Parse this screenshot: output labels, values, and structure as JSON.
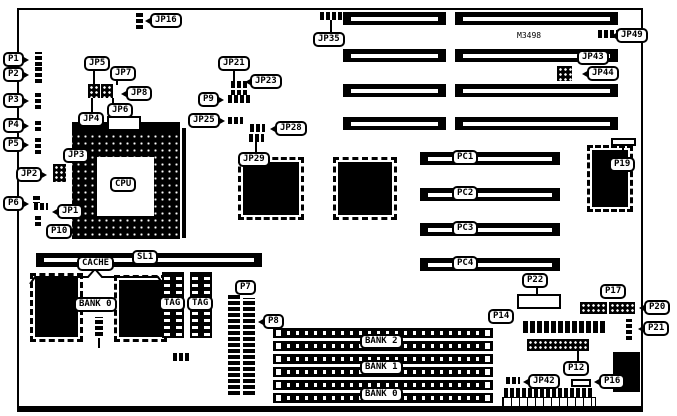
{
  "diagram": {
    "title": "motherboard jumper/connector location diagram",
    "part_number": "M3498",
    "background": "#ffffff",
    "line_color": "#000000"
  },
  "labels": [
    {
      "id": "jp16",
      "text": "JP16",
      "x": 150,
      "y": 13,
      "tail": "left"
    },
    {
      "id": "p1",
      "text": "P1",
      "x": 3,
      "y": 52,
      "tail": "right"
    },
    {
      "id": "p2",
      "text": "P2",
      "x": 3,
      "y": 67,
      "tail": "right"
    },
    {
      "id": "p3",
      "text": "P3",
      "x": 3,
      "y": 93,
      "tail": "right"
    },
    {
      "id": "p4",
      "text": "P4",
      "x": 3,
      "y": 118,
      "tail": "right"
    },
    {
      "id": "p5",
      "text": "P5",
      "x": 3,
      "y": 137,
      "tail": "right"
    },
    {
      "id": "jp2",
      "text": "JP2",
      "x": 16,
      "y": 167,
      "tail": "right"
    },
    {
      "id": "p6",
      "text": "P6",
      "x": 3,
      "y": 196,
      "tail": "right"
    },
    {
      "id": "jp1",
      "text": "JP1",
      "x": 57,
      "y": 204,
      "tail": "left"
    },
    {
      "id": "p10",
      "text": "P10",
      "x": 46,
      "y": 224,
      "tail": null
    },
    {
      "id": "jp5",
      "text": "JP5",
      "x": 84,
      "y": 56,
      "tail": null
    },
    {
      "id": "jp7",
      "text": "JP7",
      "x": 110,
      "y": 66,
      "tail": null
    },
    {
      "id": "jp8",
      "text": "JP8",
      "x": 126,
      "y": 86,
      "tail": "left"
    },
    {
      "id": "jp6",
      "text": "JP6",
      "x": 107,
      "y": 103,
      "tail": null
    },
    {
      "id": "jp4",
      "text": "JP4",
      "x": 78,
      "y": 112,
      "tail": null
    },
    {
      "id": "jp3",
      "text": "JP3",
      "x": 63,
      "y": 148,
      "tail": null
    },
    {
      "id": "jp21",
      "text": "JP21",
      "x": 218,
      "y": 56,
      "tail": null
    },
    {
      "id": "jp23",
      "text": "JP23",
      "x": 250,
      "y": 74,
      "tail": "left"
    },
    {
      "id": "p9",
      "text": "P9",
      "x": 198,
      "y": 92,
      "tail": "right"
    },
    {
      "id": "jp25",
      "text": "JP25",
      "x": 188,
      "y": 113,
      "tail": "right"
    },
    {
      "id": "jp28",
      "text": "JP28",
      "x": 275,
      "y": 121,
      "tail": "left"
    },
    {
      "id": "jp29",
      "text": "JP29",
      "x": 238,
      "y": 152,
      "tail": null
    },
    {
      "id": "jp35",
      "text": "JP35",
      "x": 313,
      "y": 32,
      "tail": null
    },
    {
      "id": "jp49",
      "text": "JP49",
      "x": 616,
      "y": 28,
      "tail": "left"
    },
    {
      "id": "jp43",
      "text": "JP43",
      "x": 577,
      "y": 50,
      "tail": null
    },
    {
      "id": "jp44",
      "text": "JP44",
      "x": 587,
      "y": 66,
      "tail": "left"
    },
    {
      "id": "pc1",
      "text": "PC1",
      "x": 452,
      "y": 150,
      "tail": null
    },
    {
      "id": "pc2",
      "text": "PC2",
      "x": 452,
      "y": 186,
      "tail": null
    },
    {
      "id": "pc3",
      "text": "PC3",
      "x": 452,
      "y": 221,
      "tail": null
    },
    {
      "id": "pc4",
      "text": "PC4",
      "x": 452,
      "y": 256,
      "tail": null
    },
    {
      "id": "p19",
      "text": "P19",
      "x": 609,
      "y": 157,
      "tail": null
    },
    {
      "id": "p22",
      "text": "P22",
      "x": 522,
      "y": 273,
      "tail": null
    },
    {
      "id": "p17",
      "text": "P17",
      "x": 600,
      "y": 284,
      "tail": null
    },
    {
      "id": "p20",
      "text": "P20",
      "x": 644,
      "y": 300,
      "tail": "left"
    },
    {
      "id": "p21",
      "text": "P21",
      "x": 643,
      "y": 321,
      "tail": "left"
    },
    {
      "id": "p14",
      "text": "P14",
      "x": 488,
      "y": 309,
      "tail": null
    },
    {
      "id": "p12",
      "text": "P12",
      "x": 563,
      "y": 361,
      "tail": null
    },
    {
      "id": "jp42",
      "text": "JP42",
      "x": 528,
      "y": 374,
      "tail": "left"
    },
    {
      "id": "p16",
      "text": "P16",
      "x": 599,
      "y": 374,
      "tail": "left"
    },
    {
      "id": "cache",
      "text": "CACHE",
      "x": 77,
      "y": 256,
      "tail": null
    },
    {
      "id": "sl1",
      "text": "SL1",
      "x": 132,
      "y": 250,
      "tail": null
    },
    {
      "id": "bank0-cache",
      "text": "BANK 0",
      "x": 74,
      "y": 297,
      "tail": null
    },
    {
      "id": "tag1",
      "text": "TAG",
      "x": 159,
      "y": 296,
      "tail": null
    },
    {
      "id": "tag2",
      "text": "TAG",
      "x": 187,
      "y": 296,
      "tail": null
    },
    {
      "id": "p7",
      "text": "P7",
      "x": 235,
      "y": 280,
      "tail": null
    },
    {
      "id": "p8",
      "text": "P8",
      "x": 263,
      "y": 314,
      "tail": "left"
    },
    {
      "id": "bank2",
      "text": "BANK 2",
      "x": 360,
      "y": 334,
      "tail": null
    },
    {
      "id": "bank1",
      "text": "BANK 1",
      "x": 360,
      "y": 360,
      "tail": null
    },
    {
      "id": "bank0-simm",
      "text": "BANK 0",
      "x": 360,
      "y": 387,
      "tail": null
    },
    {
      "id": "cpu",
      "text": "CPU",
      "x": 110,
      "y": 177,
      "tail": null
    }
  ]
}
